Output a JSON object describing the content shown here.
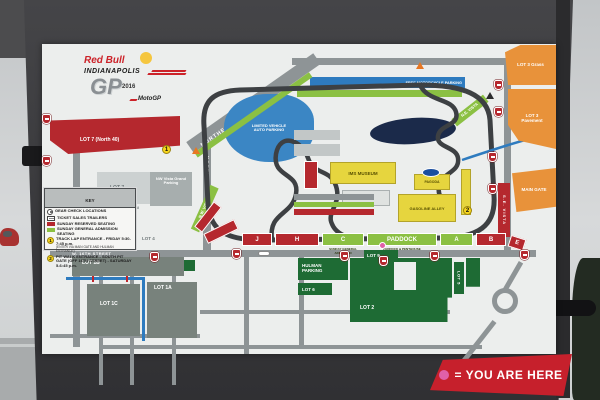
{
  "logo": {
    "brand": "Red Bull",
    "city": "INDIANAPOLIS",
    "gp": "GP",
    "year": "2016",
    "series": "MotoGP"
  },
  "legend": {
    "title": "KEY",
    "items": [
      {
        "label": "GEAR CHECK LOCATIONS"
      },
      {
        "label": "TICKET SALES TRAILERS"
      },
      {
        "label": "SUNDAY RESERVED SEATING"
      },
      {
        "label": "SUNDAY GENERAL ADMISSION SEATING"
      },
      {
        "num": "1",
        "label": "TRACK LAP ENTRANCE - FRIDAY 5:30-7:45 p.m.",
        "sub": "(ENTER VIA MAIN GATE AND HULMAN ENTRANCE)"
      },
      {
        "num": "2",
        "label": "PIT WALK ENTRANCE - SOUTH PIT GATE (OFF 16TH STREET) - SATURDAY 5-6:45 p.m."
      }
    ]
  },
  "map": {
    "lots": {
      "lot7_red": "LOT 7 (North 40)",
      "lot7": "LOT 7",
      "nw_vista_grand": "NW Vista Grand Parking",
      "premium": "PREMIUM",
      "lot4": "LOT 4",
      "lot1b": "LOT 1B",
      "lot1c": "LOT 1C",
      "lot1a": "LOT 1A",
      "lot8": "LOT 8",
      "hulman": "HULMAN PARKING",
      "lot6": "LOT 6",
      "lot9": "LOT 9",
      "lot2": "LOT 2",
      "lot5": "LOT 5",
      "lot3_grass": "LOT 3 Grass",
      "lot3_pavement": "LOT 3 Pavement",
      "main_gate": "MAIN GATE",
      "free_motorcycle": "FREE MOTORCYCLE PARKING",
      "limited_vehicle": "LIMITED VEHICLE AUTO PARKING"
    },
    "roads": {
      "northeast_vista": "NORTHEAST VISTA",
      "north_vista": "NORTH VISTA",
      "w16th": "W. 16TH STREET"
    },
    "vistas": {
      "nw": "N.W. VISTA",
      "ne": "N.E. VISTA",
      "se": "S.E. VISTA"
    },
    "buildings": {
      "museum": "IMS MUSEUM",
      "garage": "GASOLINE ALLEY",
      "pagoda": "PAGODA"
    },
    "stands": [
      {
        "label": "J"
      },
      {
        "label": "H"
      },
      {
        "label": "C",
        "sub": "SUNDAY GENERAL ADMISSION"
      },
      {
        "label": "PADDOCK",
        "sub": "PADDOCK & PENTHOUSE"
      },
      {
        "label": "A"
      },
      {
        "label": "B"
      },
      {
        "label": "E"
      }
    ],
    "markers": {
      "track_lap": "1",
      "pit_walk": "2"
    }
  },
  "banner": {
    "text": "= YOU ARE HERE"
  },
  "colors": {
    "accent_red": "#c0272d",
    "ga_green": "#8bc043",
    "parking_green": "#1e6b34",
    "lot_orange": "#e8923a",
    "building_yellow": "#e6d53e",
    "water_blue": "#2e7bbf",
    "you_are_here_pink": "#e060a8"
  }
}
